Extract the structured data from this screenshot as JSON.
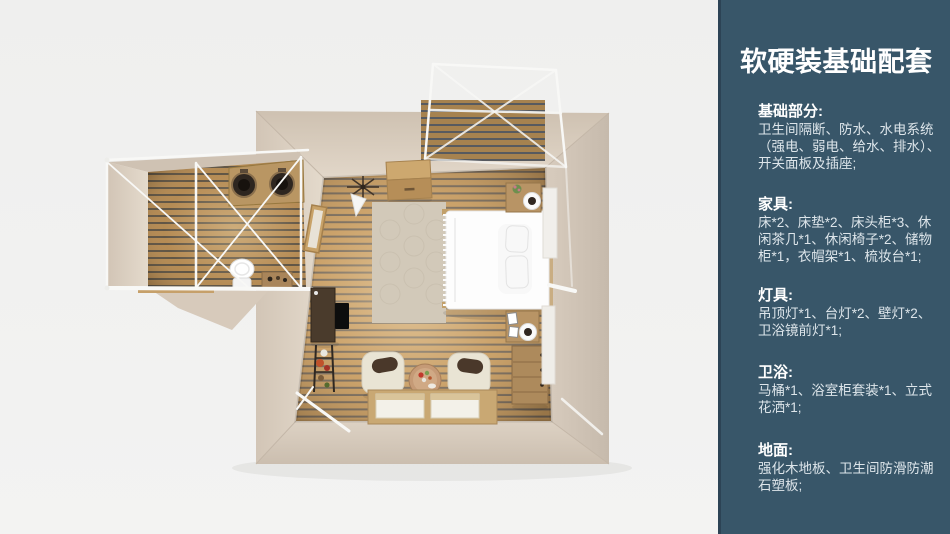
{
  "sidebar": {
    "title": "软硬装基础配套",
    "background_color": "#385669",
    "edge_color": "#2C4355",
    "heading_color": "#FFFFFF",
    "body_color": "#DDE5EA",
    "sections": [
      {
        "heading": "基础部分:",
        "lines": [
          "卫生间隔断、防水、水电系统",
          "（强电、弱电、给水、排水）、",
          "开关面板及插座;"
        ]
      },
      {
        "heading": "家具:",
        "lines": [
          "床*2、床垫*2、床头柜*3、休",
          "闲茶几*1、休闲椅子*2、储物",
          "柜*1，衣帽架*1、梳妆台*1;"
        ]
      },
      {
        "heading": "灯具:",
        "lines": [
          "吊顶灯*1、台灯*2、壁灯*2、",
          "卫浴镜前灯*1;"
        ]
      },
      {
        "heading": "卫浴:",
        "lines": [
          "马桶*1、浴室柜套装*1、立式",
          "花洒*1;"
        ]
      },
      {
        "heading": "地面:",
        "lines": [
          "强化木地板、卫生间防滑防潮",
          "石塑板;"
        ]
      }
    ]
  },
  "floorplan": {
    "background_color": "#F0F0EF",
    "wall_color": "#D6C9BA",
    "floor_slat_color": "#C2965B",
    "frame_color": "#F8F8F6",
    "scene_items": [
      "canopy-frame",
      "entry-deck",
      "bathroom-annex",
      "double-sink-vanity",
      "toilet",
      "storage-cabinet",
      "clothes-rack",
      "rug",
      "double-bed",
      "nightstand-top",
      "nightstand-bottom",
      "dresser",
      "armchair-left",
      "armchair-right",
      "coffee-table",
      "tatami-platform",
      "tv-desk",
      "plant-stand",
      "wall-mirror"
    ]
  }
}
